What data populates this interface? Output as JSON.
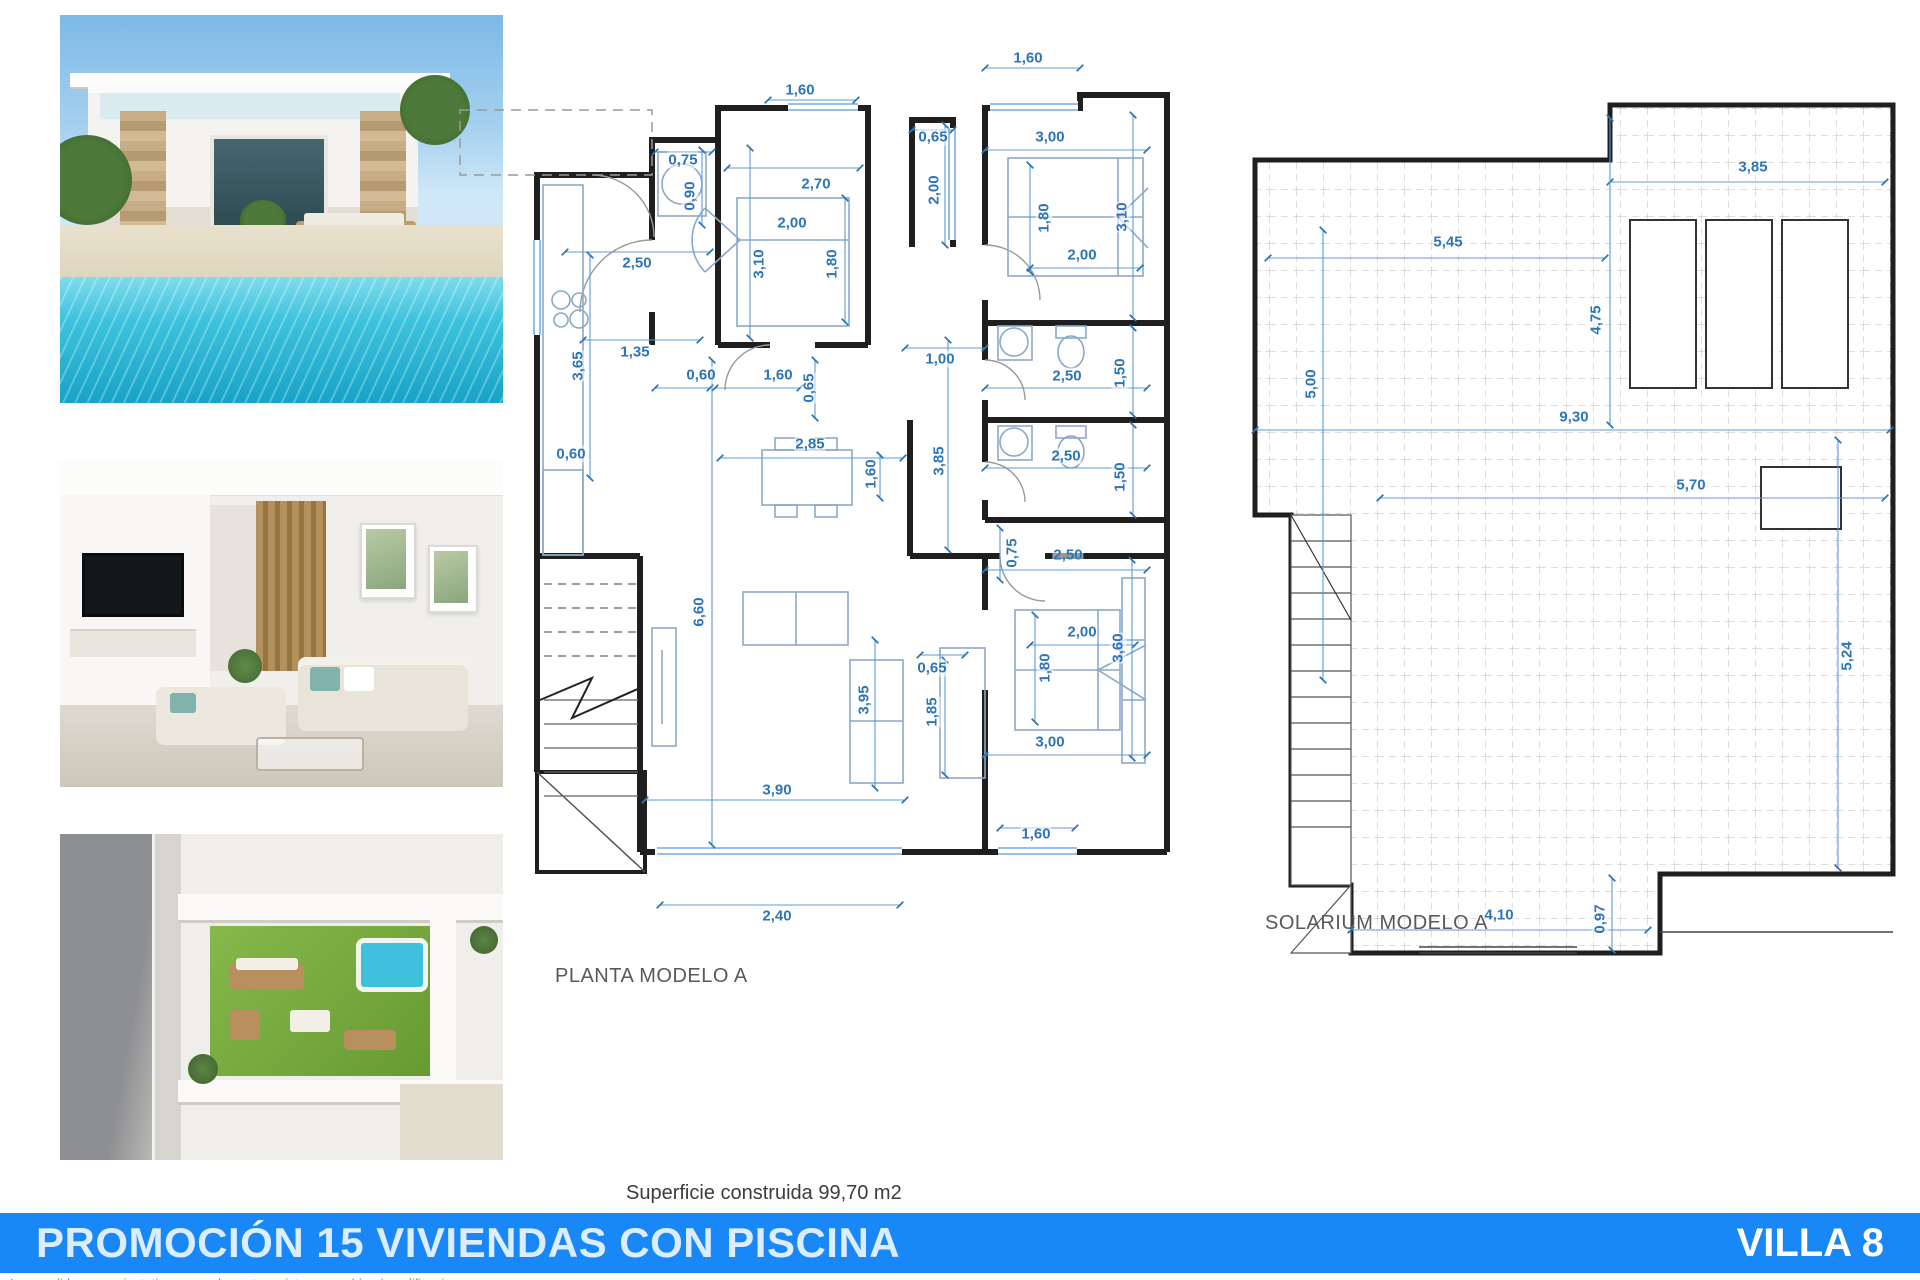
{
  "footer": {
    "title": "PROMOCIÓN 15 VIVIENDAS CON PISCINA",
    "villa": "VILLA 8",
    "bar_color": "#1987f5"
  },
  "surface_note": "Superficie construida 99,70 m2",
  "disclaimer": "Las medidas son orientativas y pueden estar sujetas a cambios / modificaciones",
  "photos": [
    {
      "name": "villa-exterior-pool"
    },
    {
      "name": "living-room-interior"
    },
    {
      "name": "rooftop-solarium-aerial"
    }
  ],
  "colors": {
    "dimension_blue": "#2e75b6",
    "wall": "#1f1f1f",
    "window_blue": "#5b9bd5",
    "caption_gray": "#595959",
    "pool": "#3cc2dc",
    "lawn": "#679a33"
  },
  "planta": {
    "caption": "PLANTA MODELO A",
    "dims": [
      {
        "t": "1,60",
        "x": 800,
        "y": 90
      },
      {
        "t": "0,75",
        "x": 683,
        "y": 160
      },
      {
        "t": "0,90",
        "x": 690,
        "y": 196,
        "v": 1
      },
      {
        "t": "2,70",
        "x": 816,
        "y": 184
      },
      {
        "t": "2,00",
        "x": 792,
        "y": 223
      },
      {
        "t": "3,10",
        "x": 759,
        "y": 264,
        "v": 1
      },
      {
        "t": "1,80",
        "x": 832,
        "y": 264,
        "v": 1
      },
      {
        "t": "0,65",
        "x": 933,
        "y": 137
      },
      {
        "t": "2,00",
        "x": 934,
        "y": 190,
        "v": 1
      },
      {
        "t": "1,60",
        "x": 1028,
        "y": 58
      },
      {
        "t": "3,00",
        "x": 1050,
        "y": 137
      },
      {
        "t": "1,80",
        "x": 1044,
        "y": 218,
        "v": 1
      },
      {
        "t": "3,10",
        "x": 1122,
        "y": 217,
        "v": 1
      },
      {
        "t": "2,00",
        "x": 1082,
        "y": 255
      },
      {
        "t": "2,50",
        "x": 637,
        "y": 263
      },
      {
        "t": "1,35",
        "x": 635,
        "y": 352
      },
      {
        "t": "3,65",
        "x": 578,
        "y": 366,
        "v": 1
      },
      {
        "t": "0,60",
        "x": 701,
        "y": 375
      },
      {
        "t": "1,60",
        "x": 778,
        "y": 375
      },
      {
        "t": "0,65",
        "x": 809,
        "y": 388,
        "v": 1
      },
      {
        "t": "1,00",
        "x": 940,
        "y": 359
      },
      {
        "t": "2,50",
        "x": 1067,
        "y": 376
      },
      {
        "t": "1,50",
        "x": 1120,
        "y": 373,
        "v": 1
      },
      {
        "t": "0,60",
        "x": 571,
        "y": 454
      },
      {
        "t": "2,85",
        "x": 810,
        "y": 444
      },
      {
        "t": "1,60",
        "x": 871,
        "y": 474,
        "v": 1
      },
      {
        "t": "3,85",
        "x": 939,
        "y": 461,
        "v": 1
      },
      {
        "t": "2,50",
        "x": 1066,
        "y": 456
      },
      {
        "t": "1,50",
        "x": 1120,
        "y": 477,
        "v": 1
      },
      {
        "t": "0,75",
        "x": 1012,
        "y": 553,
        "v": 1
      },
      {
        "t": "2,50",
        "x": 1068,
        "y": 555
      },
      {
        "t": "6,60",
        "x": 699,
        "y": 612,
        "v": 1
      },
      {
        "t": "2,00",
        "x": 1082,
        "y": 632
      },
      {
        "t": "3,60",
        "x": 1118,
        "y": 648,
        "v": 1
      },
      {
        "t": "1,80",
        "x": 1045,
        "y": 668,
        "v": 1
      },
      {
        "t": "0,65",
        "x": 932,
        "y": 668
      },
      {
        "t": "3,95",
        "x": 864,
        "y": 700,
        "v": 1
      },
      {
        "t": "1,85",
        "x": 932,
        "y": 712,
        "v": 1
      },
      {
        "t": "3,00",
        "x": 1050,
        "y": 742
      },
      {
        "t": "3,90",
        "x": 777,
        "y": 790
      },
      {
        "t": "1,60",
        "x": 1036,
        "y": 834
      },
      {
        "t": "2,40",
        "x": 777,
        "y": 916
      }
    ]
  },
  "solarium": {
    "caption": "SOLARIUM MODELO A",
    "dims": [
      {
        "t": "3,85",
        "x": 1753,
        "y": 167
      },
      {
        "t": "5,45",
        "x": 1448,
        "y": 242
      },
      {
        "t": "4,75",
        "x": 1596,
        "y": 320,
        "v": 1
      },
      {
        "t": "5,00",
        "x": 1311,
        "y": 384,
        "v": 1
      },
      {
        "t": "9,30",
        "x": 1574,
        "y": 417
      },
      {
        "t": "5,70",
        "x": 1691,
        "y": 485
      },
      {
        "t": "5,24",
        "x": 1847,
        "y": 656,
        "v": 1
      },
      {
        "t": "4,10",
        "x": 1499,
        "y": 915
      },
      {
        "t": "0,97",
        "x": 1600,
        "y": 919,
        "v": 1
      }
    ]
  }
}
